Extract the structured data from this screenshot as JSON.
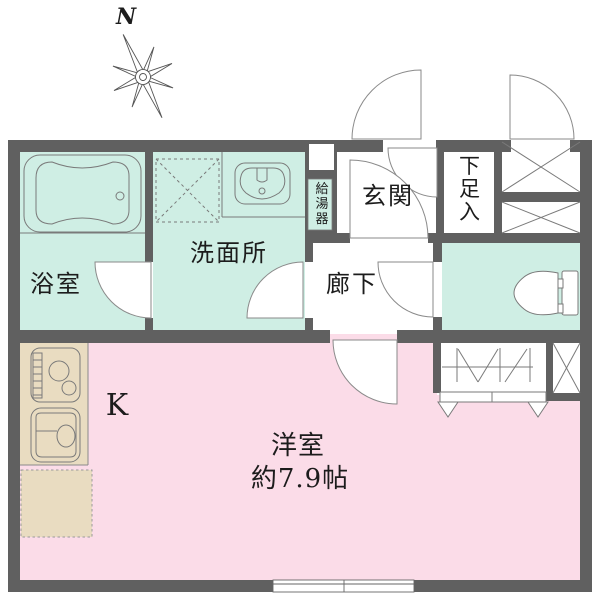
{
  "title": "floor-plan",
  "compass": {
    "north_label": "N"
  },
  "rooms": {
    "bathroom": {
      "label": "浴室"
    },
    "washroom": {
      "label": "洗面所"
    },
    "water_heater": {
      "label": "給湯器"
    },
    "entrance": {
      "label": "玄関"
    },
    "shoe_storage": {
      "label": "下足入"
    },
    "hallway": {
      "label": "廊下"
    },
    "kitchen": {
      "label": "K"
    },
    "western_room": {
      "label": "洋室",
      "size_label": "約7.9帖"
    }
  },
  "colors": {
    "wall": "#606060",
    "wet_area_mint": "#cfeee4",
    "room_pink": "#fbdce8",
    "kitchen_beige": "#e9dcc1",
    "fixture_line": "#7a7a7a",
    "background": "#ffffff"
  }
}
